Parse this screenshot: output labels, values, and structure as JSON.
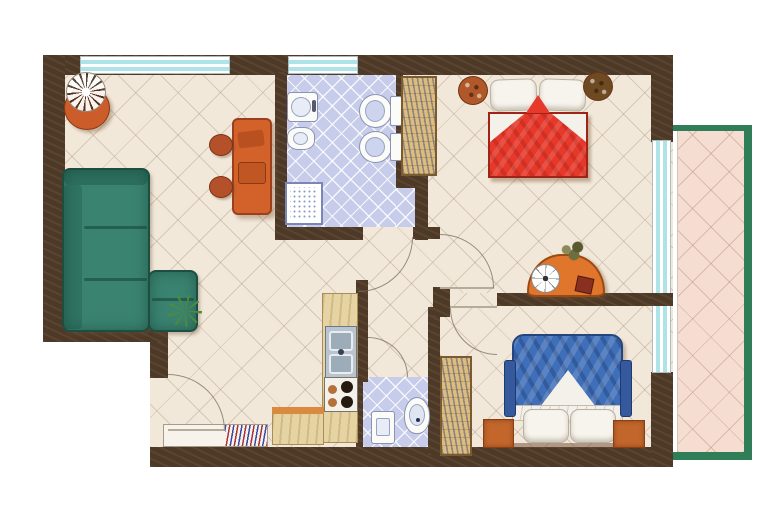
{
  "image_type": "Watercolor architectural floor plan of a two-bedroom apartment with balcony (no text labels in drawing)",
  "apartment": {
    "rooms": [
      {
        "id": "living-room",
        "position": "left",
        "furniture": [
          "corner-sofa",
          "dining-table",
          "two-chairs",
          "potted-plant",
          "small-green-plant"
        ]
      },
      {
        "id": "bathroom",
        "position": "top-center",
        "floor": "blue-tiles",
        "fixtures": [
          "washbasin",
          "bidet",
          "toilet",
          "second-toilet",
          "shower-tray"
        ]
      },
      {
        "id": "bedroom-1",
        "position": "top-right",
        "furniture": [
          "double-bed-red",
          "wardrobe-louvered",
          "bedside-plant-left",
          "bedside-plant-right",
          "dresser-with-round-mirror",
          "plant-sprig",
          "small-red-box"
        ]
      },
      {
        "id": "hallway",
        "position": "bottom-center",
        "furniture": [
          "entry-door",
          "radiator-niche"
        ]
      },
      {
        "id": "kitchen",
        "position": "bottom-center",
        "furniture": [
          "counter-column",
          "double-sink",
          "stove-four-burners",
          "lower-counter"
        ]
      },
      {
        "id": "wc",
        "position": "bottom-center-right",
        "floor": "blue-tiles",
        "fixtures": [
          "washbasin",
          "toilet"
        ]
      },
      {
        "id": "bedroom-2",
        "position": "bottom-right",
        "furniture": [
          "double-bed-blue",
          "wardrobe-louvered",
          "nightstand-left",
          "nightstand-right"
        ]
      },
      {
        "id": "balcony",
        "position": "right",
        "floor": "pink-tiles",
        "frame": "green"
      }
    ],
    "windows": [
      {
        "id": "window-living-room",
        "wall": "top"
      },
      {
        "id": "window-bathroom",
        "wall": "top"
      },
      {
        "id": "balcony-glass-doors",
        "wall": "right"
      }
    ],
    "doors": [
      {
        "id": "entry-door",
        "swing": "into-hallway"
      },
      {
        "id": "bathroom-door",
        "swing": "into-corridor"
      },
      {
        "id": "bedroom-1-door",
        "swing": "into-bedroom-1"
      },
      {
        "id": "bedroom-2-door",
        "swing": "into-bedroom-2"
      },
      {
        "id": "wc-door",
        "swing": "into-corridor"
      }
    ]
  },
  "colors": {
    "wall": "#4e3926",
    "floor": "#f2e8da",
    "bath_floor": "#c6cce9",
    "balcony_floor": "#f5ded1",
    "balcony_frame": "#2f7e57",
    "window_glass": "#aee4e8",
    "sofa": "#3b8371",
    "sofa_dark": "#1c4f41",
    "table_orange": "#d2622a",
    "chair_rust": "#b5512a",
    "bed1_red": "#e6392b",
    "bed2_blue": "#3f6fb8",
    "wood_tan": "#dcbd80",
    "counter_tan": "#e6d3a3",
    "nightstand_orange": "#c2662c",
    "plant_green": "#4e8a3a",
    "pot_orange": "#cc5d2b"
  }
}
